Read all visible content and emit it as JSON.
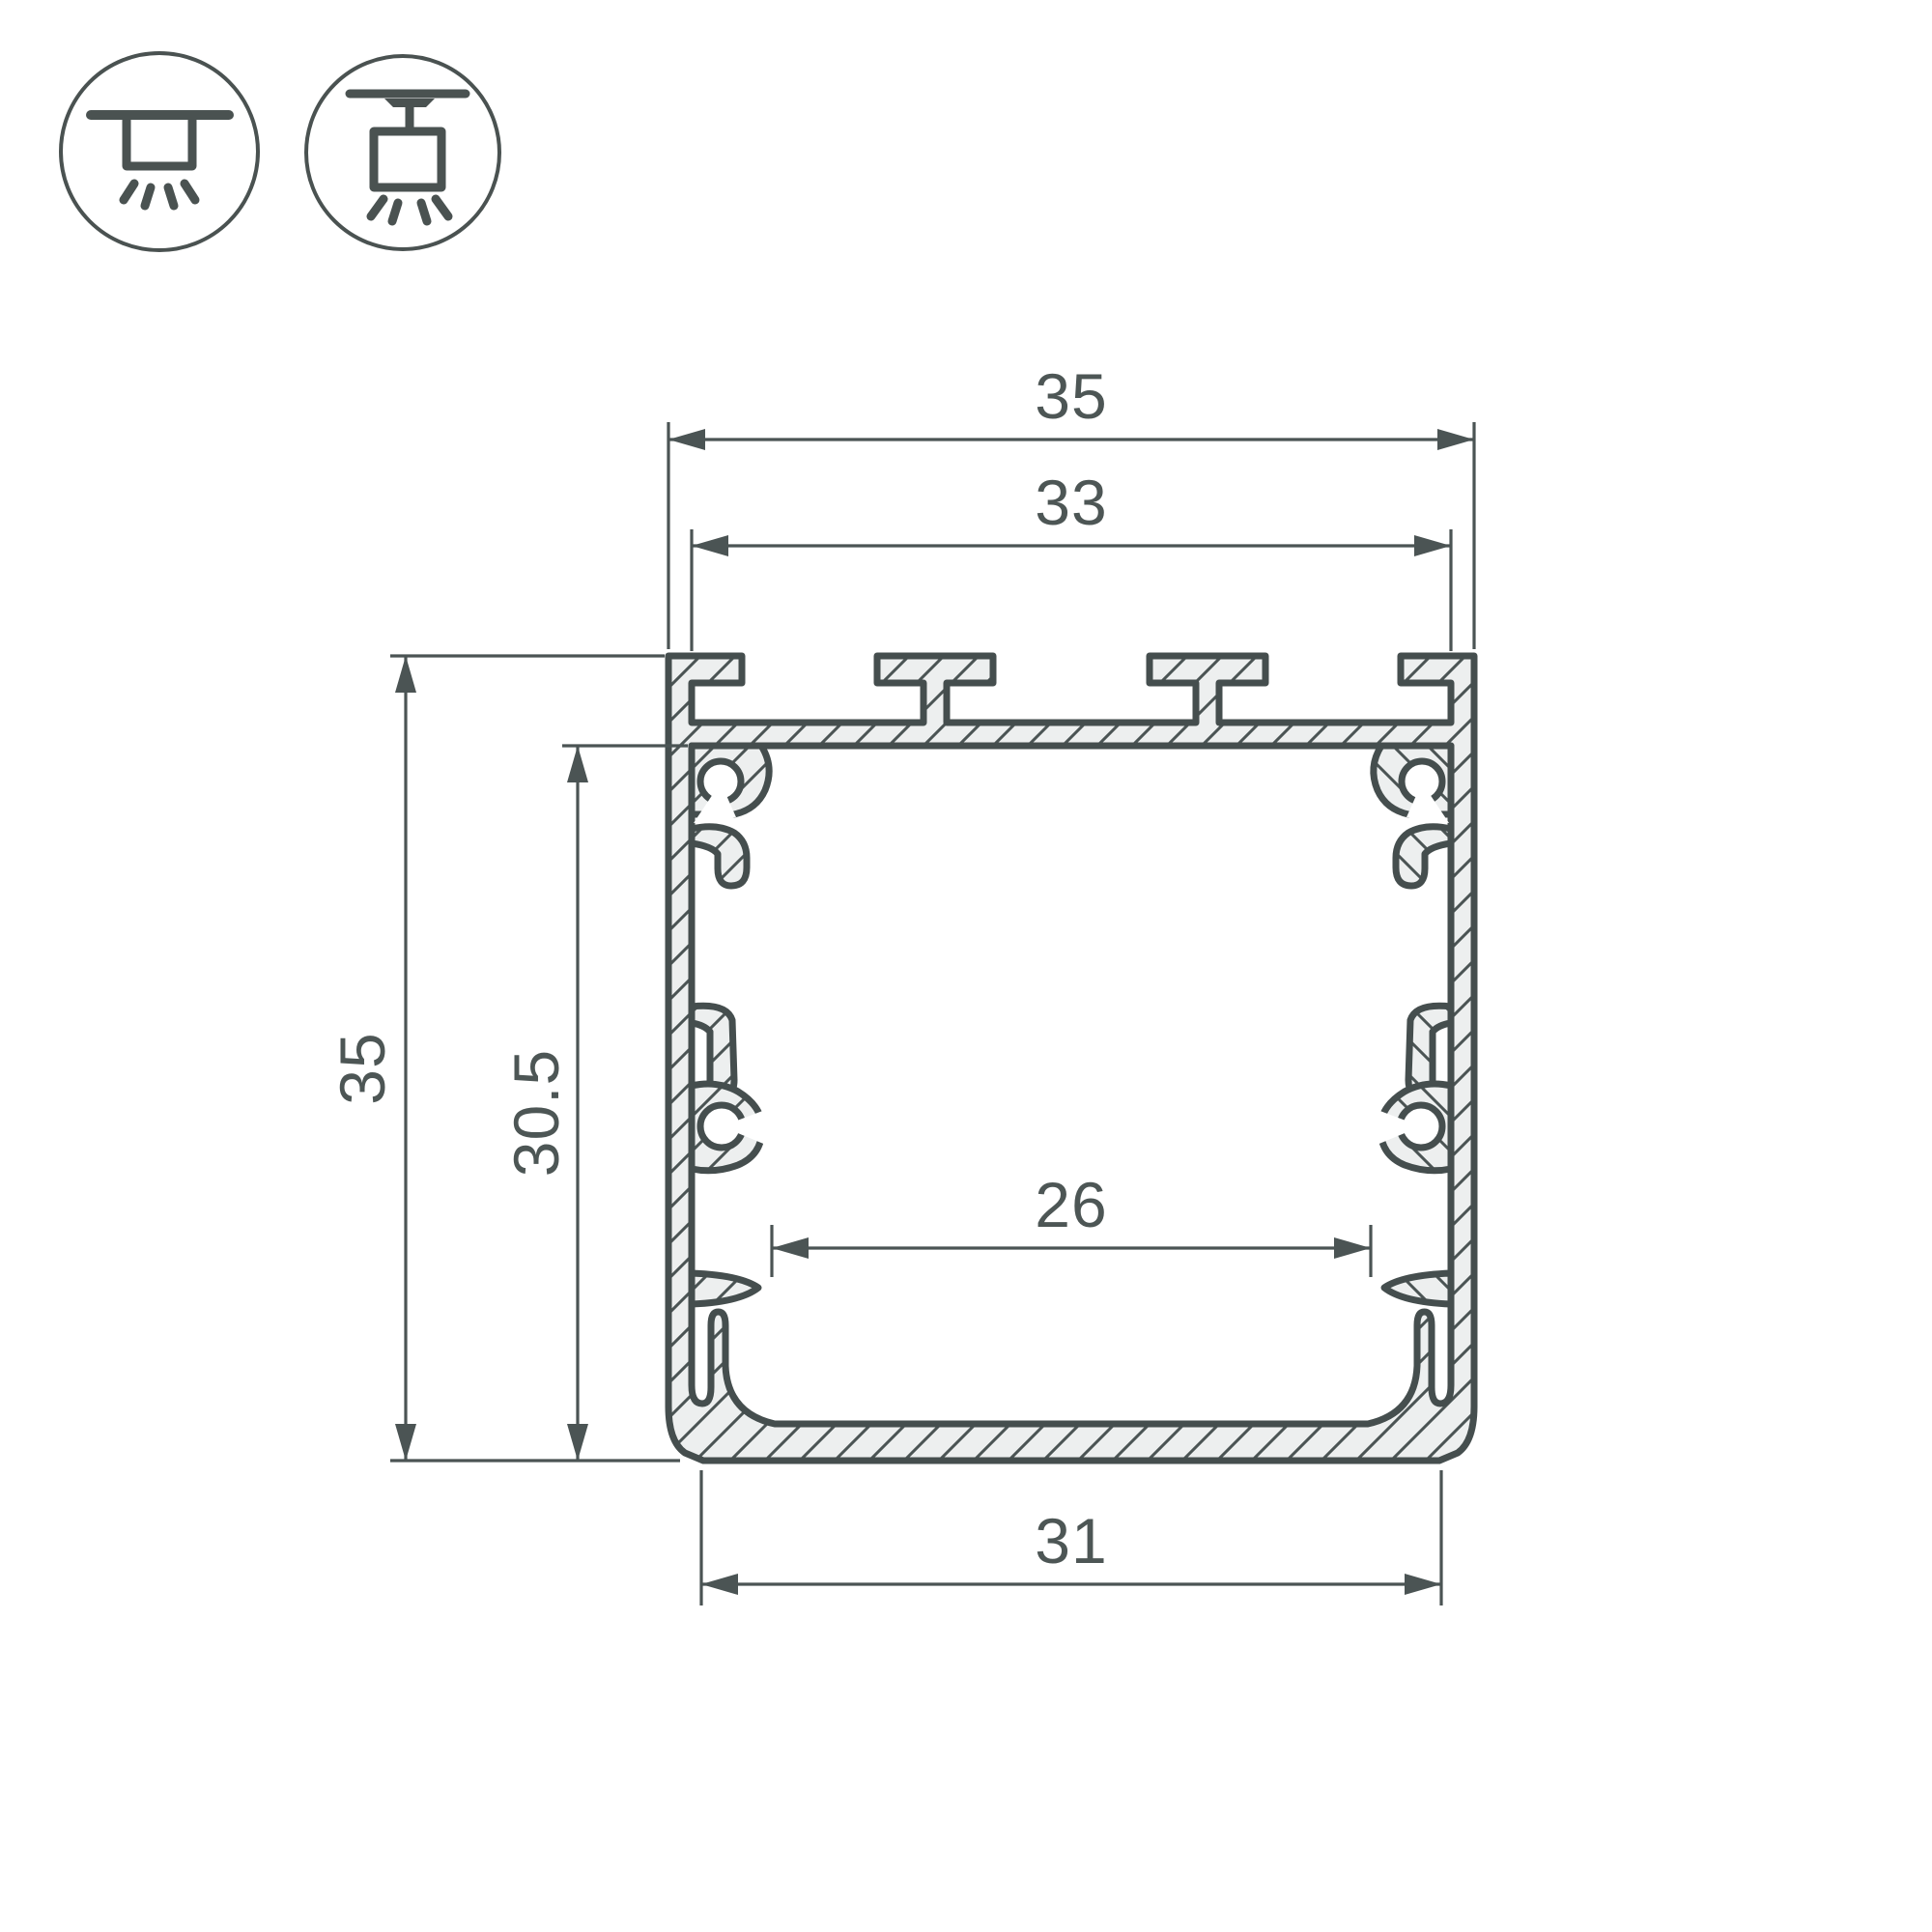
{
  "drawing": {
    "type": "profile-cross-section-dimension-drawing",
    "dimension_labels": {
      "outer_width": "35",
      "slot_span_width": "33",
      "overall_height": "35",
      "inner_height": "30.5",
      "inner_width": "26",
      "bottom_width": "31"
    },
    "icons": [
      {
        "name": "surface-mount-icon"
      },
      {
        "name": "pendant-mount-icon"
      }
    ],
    "colors": {
      "outline": "#454e4e",
      "thin_line": "#4b5454",
      "hatch_fill": "#edefef",
      "text": "#4d5655",
      "background": "#ffffff"
    }
  }
}
